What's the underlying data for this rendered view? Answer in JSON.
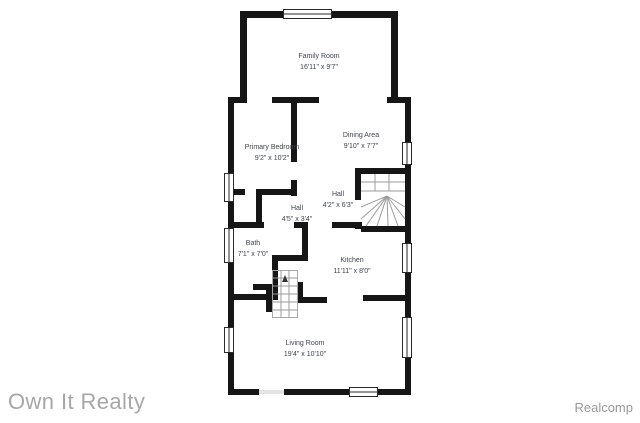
{
  "floor_plan": {
    "rooms": [
      {
        "name": "Family Room",
        "dims": "16'11\" x 9'7\""
      },
      {
        "name": "Primary Bedroom",
        "dims": "9'2\" x 10'2\""
      },
      {
        "name": "Dining Area",
        "dims": "9'10\" x 7'7\""
      },
      {
        "name": "Hall",
        "dims": "4'2\" x 6'3\""
      },
      {
        "name": "Hall",
        "dims": "4'5\" x 3'4\""
      },
      {
        "name": "Bath",
        "dims": "7'1\" x 7'0\""
      },
      {
        "name": "Kitchen",
        "dims": "11'11\" x 8'0\""
      },
      {
        "name": "Living Room",
        "dims": "19'4\" x 10'10\""
      }
    ],
    "colors": {
      "wall": "#161616",
      "label": "#40444b",
      "stair": "#9b9b9b",
      "watermark": "#a7a7a7",
      "provider": "#999999"
    }
  },
  "footer": {
    "agency": "Own It Realty",
    "provider": "Realcomp"
  }
}
